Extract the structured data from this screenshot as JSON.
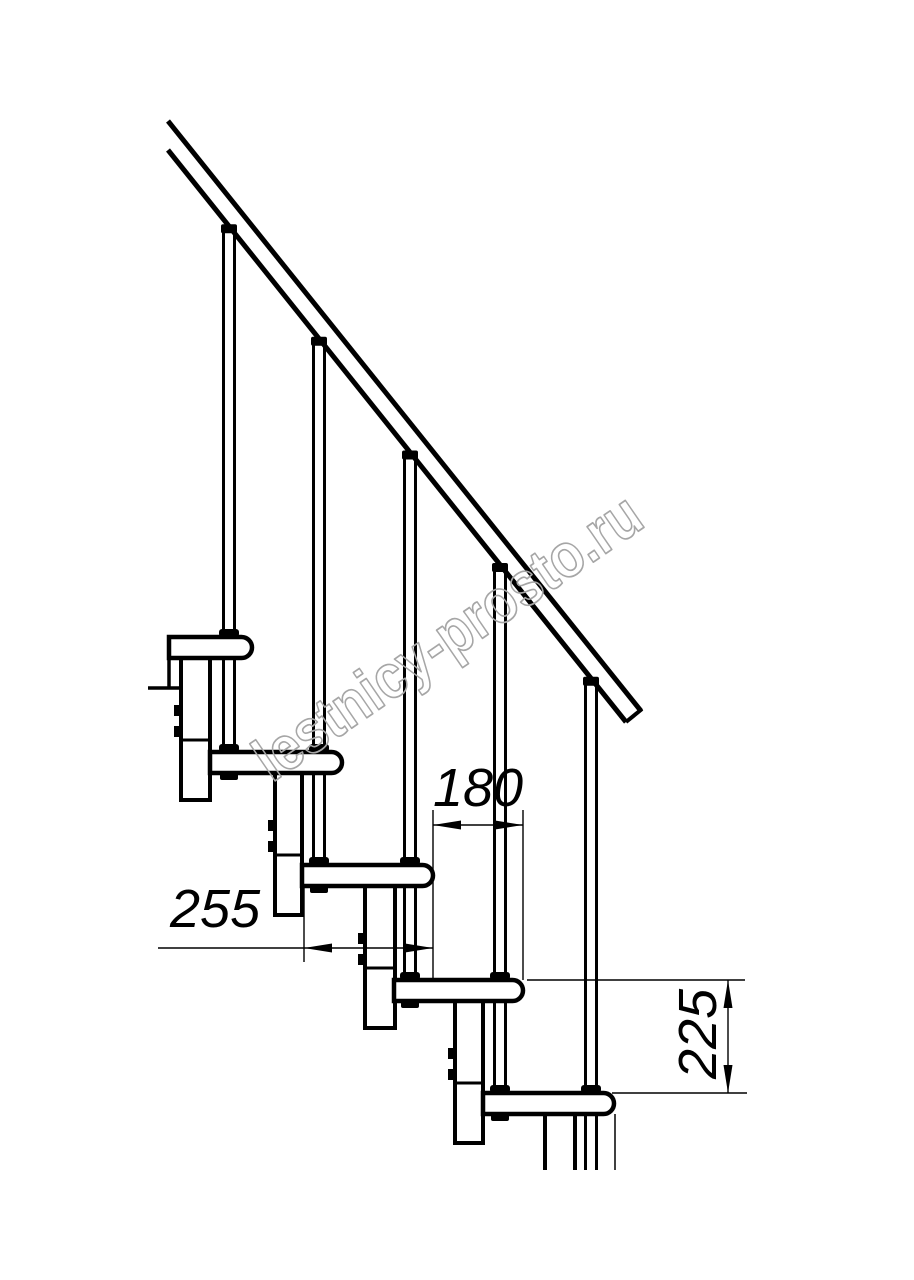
{
  "page": {
    "background": "#ffffff",
    "line_color": "#000000"
  },
  "watermark": {
    "text": "lestnicy-prosto.ru",
    "color": "#a6a6a6"
  },
  "dimensions": {
    "step_run": {
      "label": "180",
      "orientation": "horizontal"
    },
    "tread_depth": {
      "label": "255",
      "orientation": "horizontal"
    },
    "step_rise": {
      "label": "225",
      "orientation": "vertical"
    }
  },
  "drawing": {
    "type": "staircase-side-view-technical-drawing",
    "visible_steps": 5,
    "visible_balusters": 5,
    "handrail": true,
    "values_mm": {
      "step_run": 180,
      "tread_depth": 255,
      "step_rise": 225
    }
  }
}
